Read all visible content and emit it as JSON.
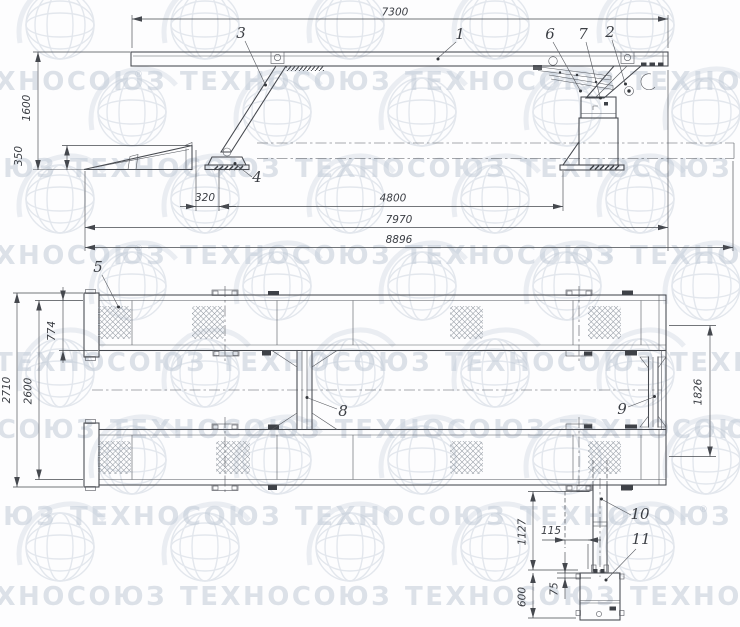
{
  "watermark": {
    "text": "ТЕХНОСОЮЗ",
    "reg": "®"
  },
  "side_view": {
    "dimensions": {
      "overall_top": "7300",
      "height": "1600",
      "ramp_height": "350",
      "ramp_gap": "320",
      "mid_span": "4800",
      "platform_length": "7970",
      "overall_length": "8896"
    },
    "part_labels": {
      "p1": "1",
      "p2": "2",
      "p3": "3",
      "p4": "4",
      "p6": "6",
      "p7": "7"
    }
  },
  "plan_view": {
    "dimensions": {
      "overall_width": "2710",
      "outer_width": "2600",
      "platform_width": "774",
      "track_spacing": "1826",
      "arm_length": "1127",
      "arm_offset": "115",
      "box_offset": "75",
      "box_height": "600"
    },
    "part_labels": {
      "p5": "5",
      "p8": "8",
      "p9": "9",
      "p10": "10",
      "p11": "11"
    }
  }
}
